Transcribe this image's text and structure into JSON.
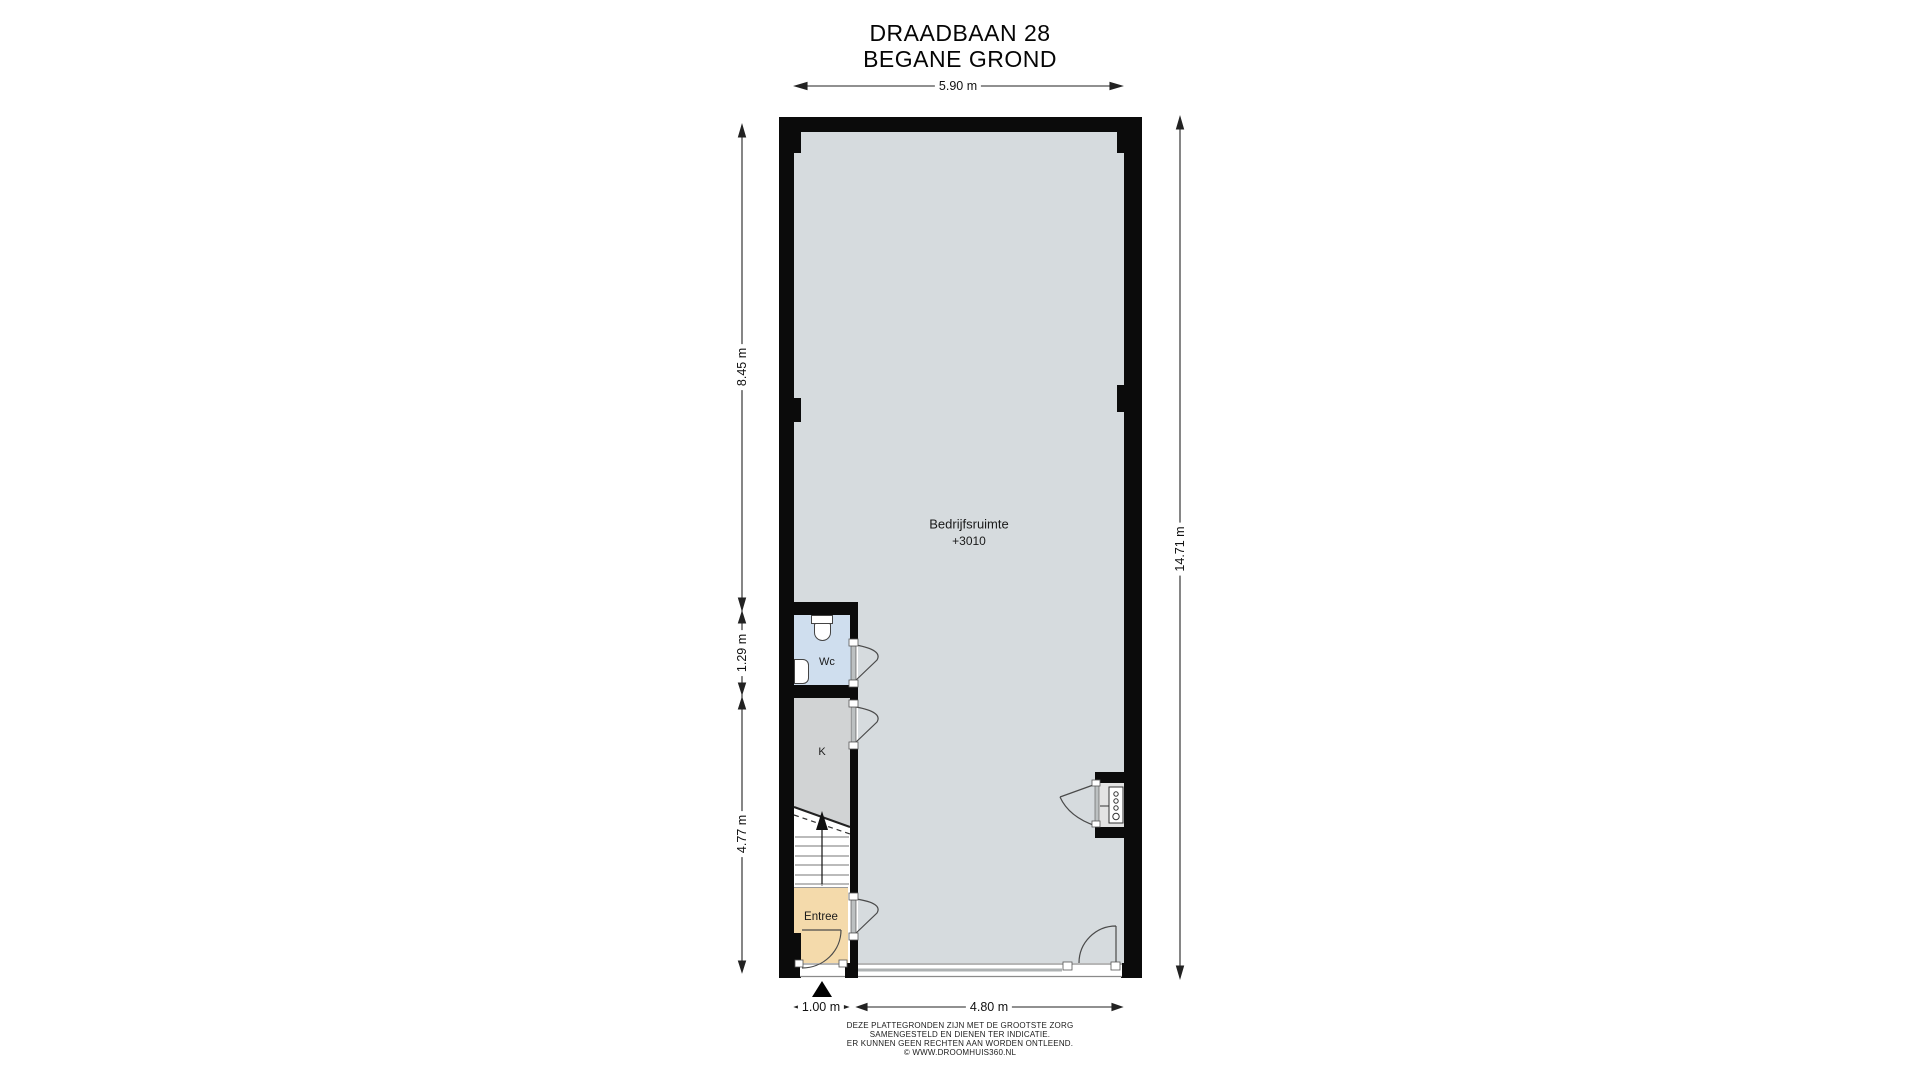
{
  "title": {
    "line1": "DRAADBAAN 28",
    "line2": "BEGANE GROND"
  },
  "dimensions": {
    "top": "5.90 m",
    "left_upper": "8.45 m",
    "left_mid": "1.29 m",
    "left_lower": "4.77 m",
    "right": "14.71 m",
    "bottom_entrance": "1.00 m",
    "bottom_front": "4.80 m"
  },
  "rooms": {
    "main": {
      "label": "Bedrijfsruimte",
      "level": "+3010"
    },
    "wc": {
      "label": "Wc"
    },
    "kitchen": {
      "label": "K"
    },
    "entrance": {
      "label": "Entree"
    }
  },
  "disclaimer": {
    "line1": "DEZE PLATTEGRONDEN ZIJN MET DE GROOTSTE ZORG",
    "line2": "SAMENGESTELD EN DIENEN TER INDICATIE.",
    "line3": "ER KUNNEN GEEN RECHTEN AAN WORDEN ONTLEEND.",
    "line4": "© WWW.DROOMHUIS360.NL"
  },
  "colors": {
    "wall": "#0b0b0b",
    "main_room": "#d6dbde",
    "wc_room": "#cfdeee",
    "kitchen_room": "#d1d3d4",
    "entrance_room": "#f4daab",
    "stairs": "#ffffff",
    "niche": "#e3e3e3",
    "door_leaf": "#bcc0c1"
  }
}
